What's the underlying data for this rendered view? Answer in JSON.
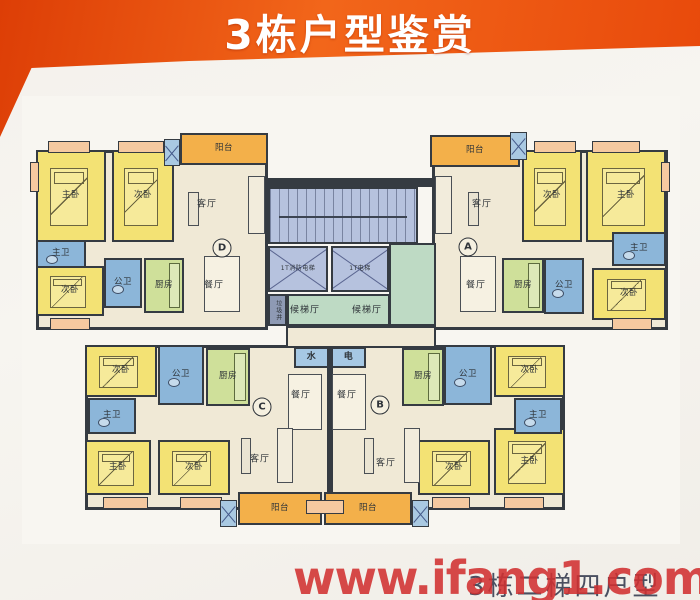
{
  "banner": {
    "title": "3栋户型鉴赏"
  },
  "footer": {
    "watermark": "www.ifang1.com",
    "caption": "3栋二梯四户型"
  },
  "palette": {
    "banner_orange": "#e8490b",
    "bedroom_yellow": "#f3e274",
    "bathroom_blue": "#8cb6d9",
    "kitchen_green": "#cfe09a",
    "living_cream": "#f0e9d6",
    "balcony_orange": "#f3b04a",
    "lobby_green": "#bedac4",
    "stairs_blue": "#b6c2de",
    "wall_dark": "#353b42",
    "watermark_red": "#d03030"
  },
  "rooms": [
    {
      "name": "unit-d-area",
      "type": "unitbg",
      "x": 36,
      "y": 150,
      "w": 232,
      "h": 180
    },
    {
      "name": "unit-a-area",
      "type": "unitbg",
      "x": 432,
      "y": 150,
      "w": 236,
      "h": 180
    },
    {
      "name": "unit-c-area",
      "type": "unitbg",
      "x": 85,
      "y": 345,
      "w": 245,
      "h": 165
    },
    {
      "name": "unit-b-area",
      "type": "unitbg",
      "x": 330,
      "y": 345,
      "w": 235,
      "h": 165
    },
    {
      "name": "core-corridor",
      "type": "corridor",
      "x": 286,
      "y": 326,
      "w": 150,
      "h": 22
    },
    {
      "name": "core-top-wall",
      "type": "wall",
      "x": 268,
      "y": 178,
      "w": 168,
      "h": 9
    },
    {
      "name": "stairwell",
      "type": "stairs",
      "x": 268,
      "y": 187,
      "w": 150,
      "h": 57
    },
    {
      "name": "fire-elevator",
      "type": "elevator",
      "label": "1T消防电梯",
      "x": 268,
      "y": 246,
      "w": 60,
      "h": 46
    },
    {
      "name": "passenger-elevator",
      "type": "elevator",
      "label": "1T电梯",
      "x": 331,
      "y": 246,
      "w": 58,
      "h": 46
    },
    {
      "name": "garbage-chute",
      "type": "garbage",
      "label": "垃圾井",
      "x": 268,
      "y": 294,
      "w": 19,
      "h": 32
    },
    {
      "name": "elevator-lobby",
      "type": "lobby",
      "x": 287,
      "y": 294,
      "w": 103,
      "h": 32
    },
    {
      "name": "elevator-lobby-east",
      "type": "lobby",
      "x": 389,
      "y": 243,
      "w": 47,
      "h": 83
    },
    {
      "name": "water-meter-room",
      "type": "meter",
      "label": "水",
      "x": 294,
      "y": 347,
      "w": 35,
      "h": 21
    },
    {
      "name": "electric-meter-room",
      "type": "meter",
      "label": "电",
      "x": 331,
      "y": 347,
      "w": 35,
      "h": 21
    },
    {
      "name": "unit-d-master-bedroom",
      "type": "bed",
      "label": "主卧",
      "x": 36,
      "y": 150,
      "w": 70,
      "h": 92
    },
    {
      "name": "unit-d-bedroom-2",
      "type": "bed",
      "label": "次卧",
      "x": 112,
      "y": 150,
      "w": 62,
      "h": 92
    },
    {
      "name": "unit-d-bedroom-3",
      "type": "bed",
      "label": "次卧",
      "x": 36,
      "y": 266,
      "w": 68,
      "h": 50
    },
    {
      "name": "unit-a-bedroom-2",
      "type": "bed",
      "label": "次卧",
      "x": 522,
      "y": 150,
      "w": 60,
      "h": 92
    },
    {
      "name": "unit-a-master-bedroom",
      "type": "bed",
      "label": "主卧",
      "x": 586,
      "y": 150,
      "w": 80,
      "h": 92
    },
    {
      "name": "unit-a-bedroom-3",
      "type": "bed",
      "label": "次卧",
      "x": 592,
      "y": 268,
      "w": 74,
      "h": 52
    },
    {
      "name": "unit-c-bedroom-2",
      "type": "bed",
      "label": "次卧",
      "x": 85,
      "y": 345,
      "w": 72,
      "h": 52
    },
    {
      "name": "unit-c-master-bedroom",
      "type": "bed",
      "label": "主卧",
      "x": 85,
      "y": 440,
      "w": 66,
      "h": 55
    },
    {
      "name": "unit-c-bedroom-3",
      "type": "bed",
      "label": "次卧",
      "x": 158,
      "y": 440,
      "w": 72,
      "h": 55
    },
    {
      "name": "unit-b-bedroom-2",
      "type": "bed",
      "label": "次卧",
      "x": 494,
      "y": 345,
      "w": 71,
      "h": 52
    },
    {
      "name": "unit-b-bedroom-3",
      "type": "bed",
      "label": "次卧",
      "x": 418,
      "y": 440,
      "w": 72,
      "h": 55
    },
    {
      "name": "unit-b-master-bedroom",
      "type": "bed",
      "label": "主卧",
      "x": 494,
      "y": 428,
      "w": 71,
      "h": 67
    },
    {
      "name": "unit-d-master-bath",
      "type": "bath",
      "label": "主卫",
      "x": 36,
      "y": 240,
      "w": 50,
      "h": 28
    },
    {
      "name": "unit-d-common-bath",
      "type": "bath",
      "label": "公卫",
      "x": 104,
      "y": 258,
      "w": 38,
      "h": 50
    },
    {
      "name": "unit-a-master-bath",
      "type": "bath",
      "label": "主卫",
      "x": 612,
      "y": 232,
      "w": 54,
      "h": 34
    },
    {
      "name": "unit-a-common-bath",
      "type": "bath",
      "label": "公卫",
      "x": 544,
      "y": 258,
      "w": 40,
      "h": 56
    },
    {
      "name": "unit-c-common-bath",
      "type": "bath",
      "label": "公卫",
      "x": 158,
      "y": 345,
      "w": 46,
      "h": 60
    },
    {
      "name": "unit-c-master-bath",
      "type": "bath",
      "label": "主卫",
      "x": 88,
      "y": 398,
      "w": 48,
      "h": 36
    },
    {
      "name": "unit-b-common-bath",
      "type": "bath",
      "label": "公卫",
      "x": 444,
      "y": 345,
      "w": 48,
      "h": 60
    },
    {
      "name": "unit-b-master-bath",
      "type": "bath",
      "label": "主卫",
      "x": 514,
      "y": 398,
      "w": 48,
      "h": 36
    },
    {
      "name": "unit-d-kitchen",
      "type": "kitchen",
      "label": "厨房",
      "x": 144,
      "y": 258,
      "w": 40,
      "h": 55
    },
    {
      "name": "unit-a-kitchen",
      "type": "kitchen",
      "label": "厨房",
      "x": 502,
      "y": 258,
      "w": 42,
      "h": 55
    },
    {
      "name": "unit-c-kitchen",
      "type": "kitchen",
      "label": "厨房",
      "x": 206,
      "y": 348,
      "w": 44,
      "h": 58
    },
    {
      "name": "unit-b-kitchen",
      "type": "kitchen",
      "label": "厨房",
      "x": 402,
      "y": 348,
      "w": 42,
      "h": 58
    },
    {
      "name": "unit-d-balcony",
      "type": "balcony",
      "label": "阳台",
      "x": 180,
      "y": 133,
      "w": 88,
      "h": 32
    },
    {
      "name": "unit-a-balcony",
      "type": "balcony",
      "label": "阳台",
      "x": 430,
      "y": 135,
      "w": 90,
      "h": 32
    },
    {
      "name": "unit-c-balcony",
      "type": "balcony",
      "label": "阳台",
      "x": 238,
      "y": 492,
      "w": 84,
      "h": 33
    },
    {
      "name": "unit-b-balcony",
      "type": "balcony",
      "label": "阳台",
      "x": 324,
      "y": 492,
      "w": 88,
      "h": 33
    },
    {
      "name": "window-box",
      "type": "winbox",
      "x": 48,
      "y": 141,
      "w": 42,
      "h": 12
    },
    {
      "name": "window-box",
      "type": "winbox",
      "x": 118,
      "y": 141,
      "w": 46,
      "h": 12
    },
    {
      "name": "window-box",
      "type": "winbox",
      "x": 534,
      "y": 141,
      "w": 42,
      "h": 12
    },
    {
      "name": "window-box",
      "type": "winbox",
      "x": 592,
      "y": 141,
      "w": 48,
      "h": 12
    },
    {
      "name": "window-box",
      "type": "winbox",
      "x": 103,
      "y": 497,
      "w": 45,
      "h": 12
    },
    {
      "name": "window-box",
      "type": "winbox",
      "x": 180,
      "y": 497,
      "w": 42,
      "h": 12
    },
    {
      "name": "window-box",
      "type": "winbox",
      "x": 432,
      "y": 497,
      "w": 38,
      "h": 12
    },
    {
      "name": "window-box",
      "type": "winbox",
      "x": 504,
      "y": 497,
      "w": 40,
      "h": 12
    },
    {
      "name": "window-box",
      "type": "winbox",
      "x": 50,
      "y": 318,
      "w": 40,
      "h": 12
    },
    {
      "name": "window-box",
      "type": "winbox",
      "x": 612,
      "y": 318,
      "w": 40,
      "h": 12
    },
    {
      "name": "window-box",
      "type": "winbox",
      "x": 306,
      "y": 500,
      "w": 38,
      "h": 14
    },
    {
      "name": "window-box",
      "type": "winbox",
      "x": 30,
      "y": 162,
      "w": 9,
      "h": 30
    },
    {
      "name": "window-box",
      "type": "winbox",
      "x": 661,
      "y": 162,
      "w": 9,
      "h": 30
    },
    {
      "name": "ac-platform",
      "type": "acunit",
      "x": 164,
      "y": 139,
      "w": 16,
      "h": 27
    },
    {
      "name": "ac-platform",
      "type": "acunit",
      "x": 510,
      "y": 132,
      "w": 17,
      "h": 28
    },
    {
      "name": "ac-platform",
      "type": "acunit",
      "x": 220,
      "y": 500,
      "w": 17,
      "h": 27
    },
    {
      "name": "ac-platform",
      "type": "acunit",
      "x": 412,
      "y": 500,
      "w": 17,
      "h": 27
    },
    {
      "name": "unit-d-dining-table",
      "type": "table",
      "x": 204,
      "y": 256,
      "w": 36,
      "h": 56
    },
    {
      "name": "unit-a-dining-table",
      "type": "table",
      "x": 460,
      "y": 256,
      "w": 36,
      "h": 56
    },
    {
      "name": "unit-c-dining-table",
      "type": "table",
      "x": 288,
      "y": 374,
      "w": 34,
      "h": 56
    },
    {
      "name": "unit-b-dining-table",
      "type": "table",
      "x": 332,
      "y": 374,
      "w": 34,
      "h": 56
    },
    {
      "name": "unit-d-sofa",
      "type": "sofa",
      "x": 248,
      "y": 176,
      "w": 17,
      "h": 58
    },
    {
      "name": "unit-a-sofa",
      "type": "sofa",
      "x": 435,
      "y": 176,
      "w": 17,
      "h": 58
    },
    {
      "name": "unit-c-sofa",
      "type": "sofa",
      "x": 277,
      "y": 428,
      "w": 16,
      "h": 55
    },
    {
      "name": "unit-b-sofa",
      "type": "sofa",
      "x": 404,
      "y": 428,
      "w": 16,
      "h": 55
    },
    {
      "name": "unit-d-tv-cabinet",
      "type": "tv",
      "x": 188,
      "y": 192,
      "w": 11,
      "h": 34
    },
    {
      "name": "unit-a-tv-cabinet",
      "type": "tv",
      "x": 468,
      "y": 192,
      "w": 11,
      "h": 34
    },
    {
      "name": "unit-c-tv-cabinet",
      "type": "tv",
      "x": 241,
      "y": 438,
      "w": 10,
      "h": 36
    },
    {
      "name": "unit-b-tv-cabinet",
      "type": "tv",
      "x": 364,
      "y": 438,
      "w": 10,
      "h": 36
    }
  ],
  "labels": [
    {
      "name": "unit-d-living-label",
      "text": "客厅",
      "x": 207,
      "y": 203
    },
    {
      "name": "unit-a-living-label",
      "text": "客厅",
      "x": 482,
      "y": 203
    },
    {
      "name": "unit-c-living-label",
      "text": "客厅",
      "x": 260,
      "y": 458
    },
    {
      "name": "unit-b-living-label",
      "text": "客厅",
      "x": 386,
      "y": 462
    },
    {
      "name": "unit-d-dining-label",
      "text": "餐厅",
      "x": 214,
      "y": 284
    },
    {
      "name": "unit-a-dining-label",
      "text": "餐厅",
      "x": 476,
      "y": 284
    },
    {
      "name": "unit-c-dining-label",
      "text": "餐厅",
      "x": 301,
      "y": 394
    },
    {
      "name": "unit-b-dining-label",
      "text": "餐厅",
      "x": 347,
      "y": 394
    },
    {
      "name": "lobby-label-west",
      "text": "候梯厅",
      "x": 305,
      "y": 309
    },
    {
      "name": "lobby-label-east",
      "text": "候梯厅",
      "x": 367,
      "y": 309
    }
  ],
  "badges": [
    {
      "id": "D",
      "x": 222,
      "y": 248
    },
    {
      "id": "A",
      "x": 468,
      "y": 247
    },
    {
      "id": "C",
      "x": 262,
      "y": 407
    },
    {
      "id": "B",
      "x": 380,
      "y": 405
    }
  ]
}
